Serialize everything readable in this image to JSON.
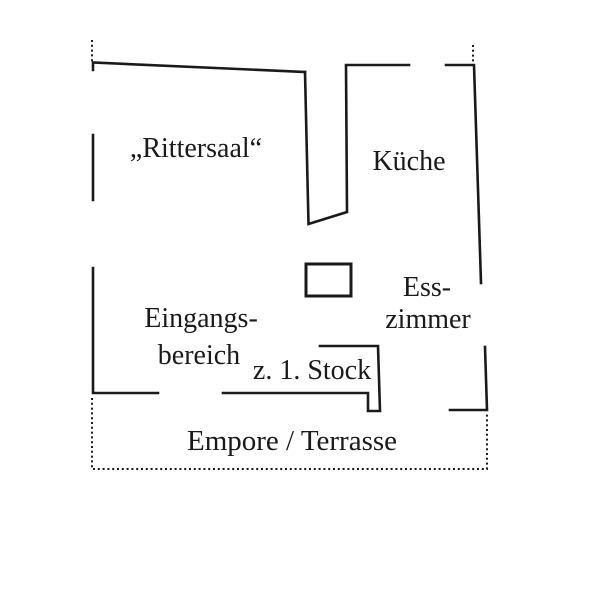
{
  "floor_plan": {
    "rooms": {
      "rittersaal": "„Rittersaal“",
      "kueche": "Küche",
      "esszimmer": {
        "line1": "Ess-",
        "line2": "zimmer"
      },
      "eingangsbereich": {
        "line1": "Eingangs-",
        "line2": "bereich"
      },
      "stairs": "z. 1. Stock",
      "terrace": "Empore / Terrasse"
    },
    "colors": {
      "line": "#1a1a1a",
      "background": "#ffffff"
    }
  }
}
